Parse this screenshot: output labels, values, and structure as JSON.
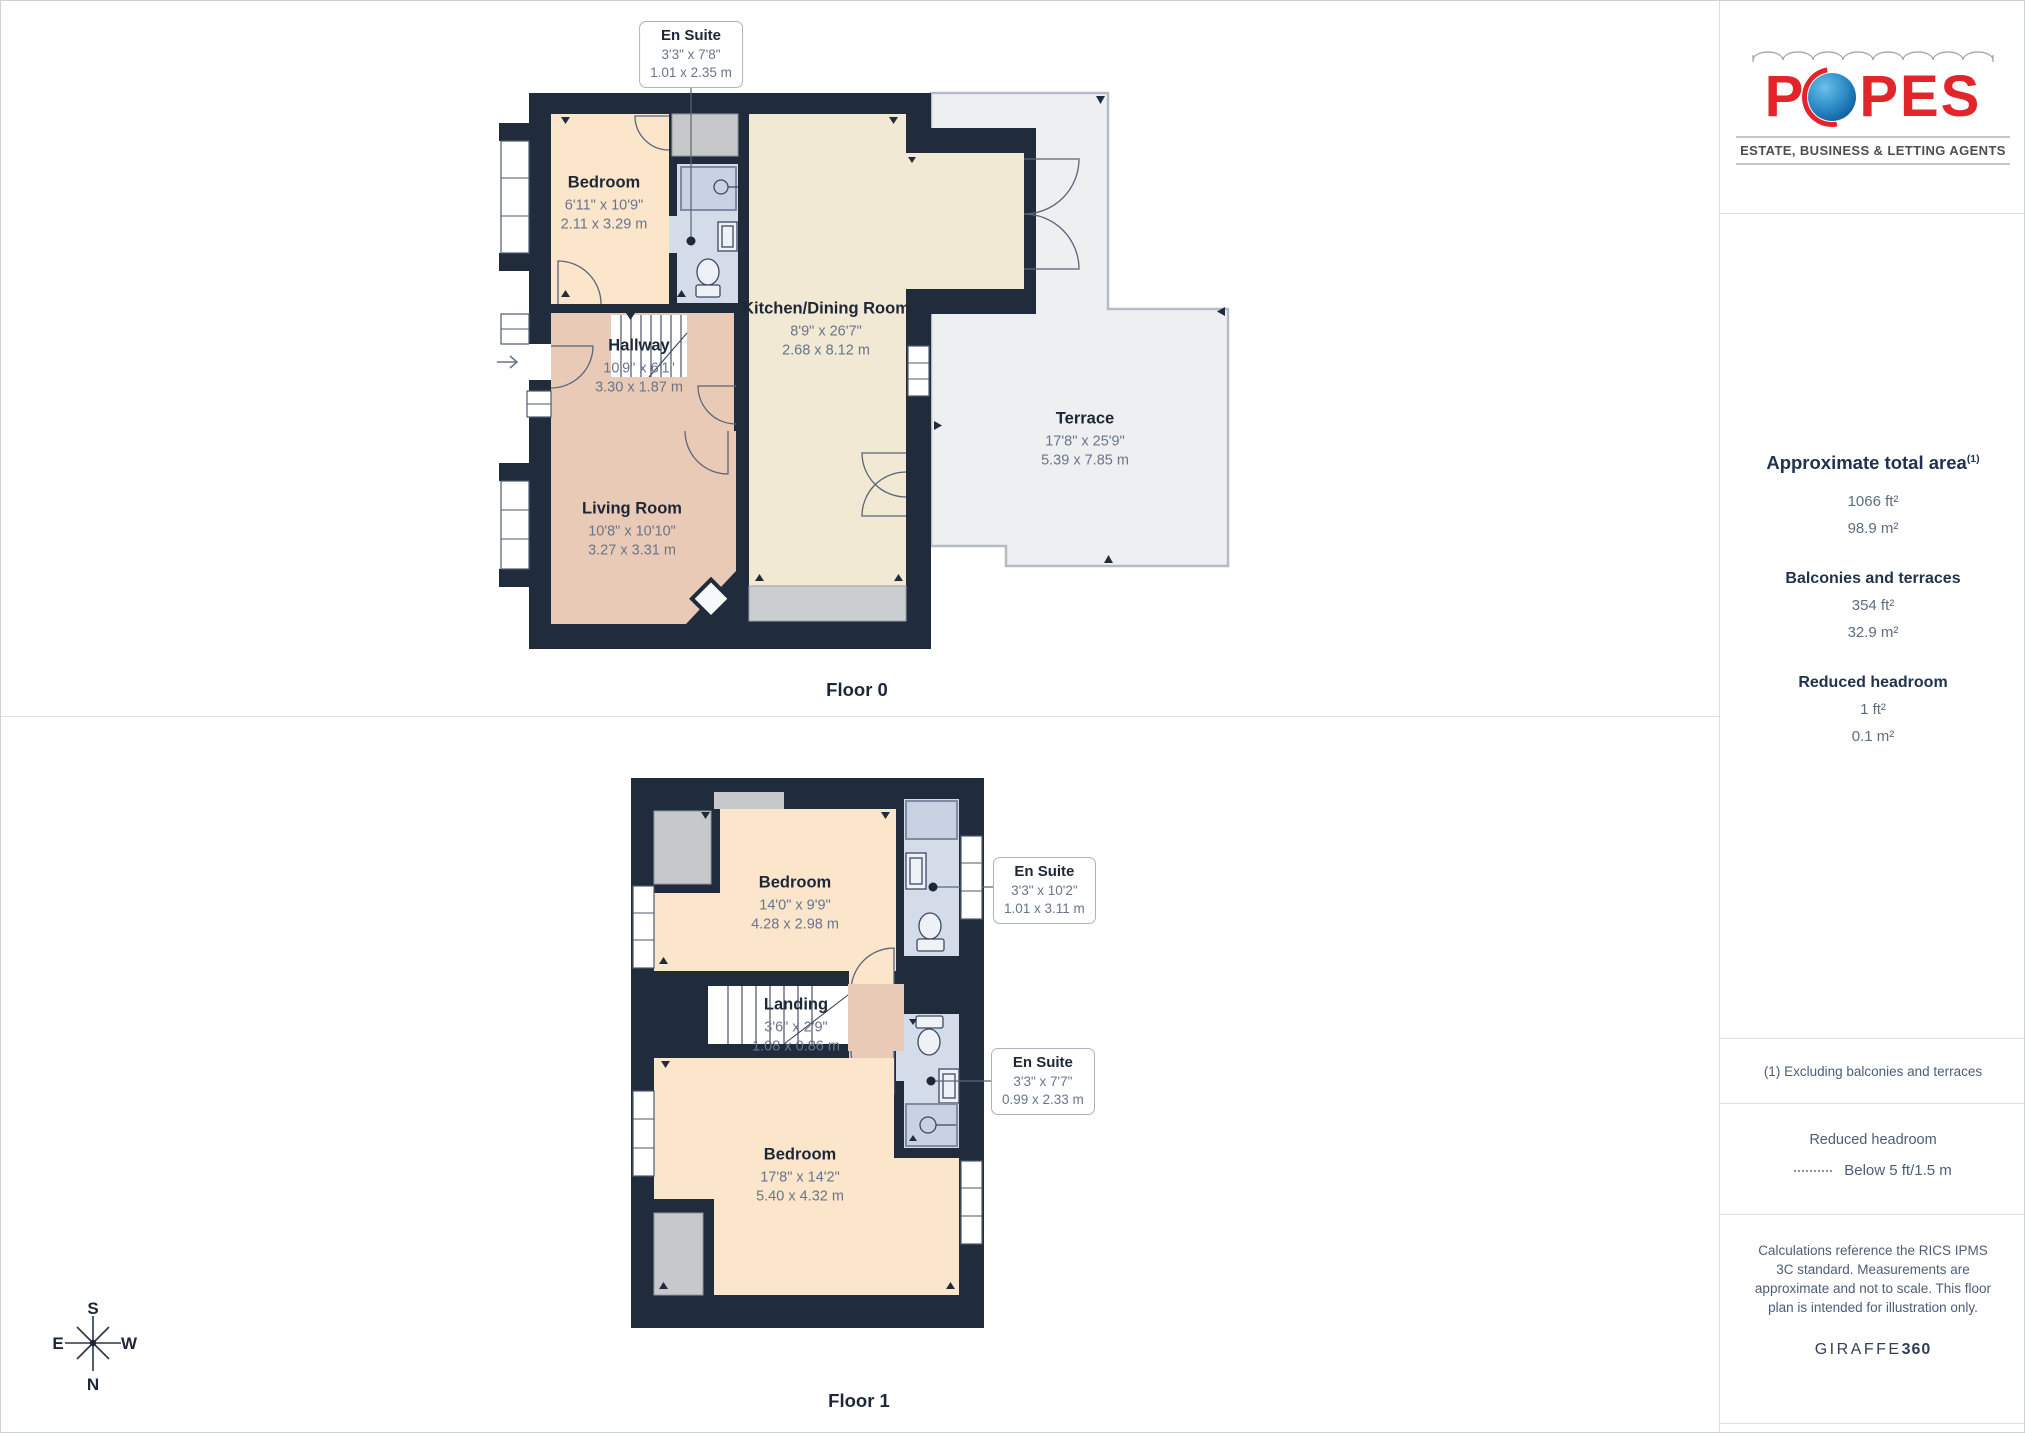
{
  "floor0": {
    "title": "Floor 0",
    "rooms": [
      {
        "name": "Bedroom",
        "imperial": "6'11\" x 10'9\"",
        "metric": "2.11 x 3.29 m"
      },
      {
        "name": "Kitchen/Dining Room",
        "imperial": "8'9\" x 26'7\"",
        "metric": "2.68 x 8.12 m"
      },
      {
        "name": "Hallway",
        "imperial": "10'9\" x 6'1\"",
        "metric": "3.30 x 1.87 m"
      },
      {
        "name": "Living Room",
        "imperial": "10'8\" x 10'10\"",
        "metric": "3.27 x 3.31 m"
      },
      {
        "name": "Terrace",
        "imperial": "17'8\" x 25'9\"",
        "metric": "5.39 x 7.85 m"
      }
    ],
    "callouts": [
      {
        "name": "En Suite",
        "imperial": "3'3\" x 7'8\"",
        "metric": "1.01 x 2.35 m"
      }
    ]
  },
  "floor1": {
    "title": "Floor 1",
    "rooms": [
      {
        "name": "Bedroom",
        "imperial": "14'0\" x 9'9\"",
        "metric": "4.28 x 2.98 m"
      },
      {
        "name": "Landing",
        "imperial": "3'6\" x 2'9\"",
        "metric": "1.08 x 0.86 m"
      },
      {
        "name": "Bedroom",
        "imperial": "17'8\" x 14'2\"",
        "metric": "5.40 x 4.32 m"
      }
    ],
    "callouts": [
      {
        "name": "En Suite",
        "imperial": "3'3\" x 10'2\"",
        "metric": "1.01 x 3.11 m"
      },
      {
        "name": "En Suite",
        "imperial": "3'3\" x 7'7\"",
        "metric": "0.99 x 2.33 m"
      }
    ]
  },
  "compass": {
    "n": "N",
    "s": "S",
    "e": "E",
    "w": "W"
  },
  "sidebar": {
    "logo": {
      "left": "P",
      "right": "PES",
      "tagline": "ESTATE, BUSINESS & LETTING AGENTS"
    },
    "areas": {
      "title": "Approximate total area",
      "title_sup": "(1)",
      "total_ft": "1066 ft²",
      "total_m": "98.9 m²",
      "balconies_heading": "Balconies and terraces",
      "balconies_ft": "354 ft²",
      "balconies_m": "32.9 m²",
      "reduced_heading": "Reduced headroom",
      "reduced_ft": "1 ft²",
      "reduced_m": "0.1 m²"
    },
    "footnote": "(1) Excluding balconies and terraces",
    "legend": {
      "title": "Reduced headroom",
      "value": "Below 5 ft/1.5 m"
    },
    "disclaimer": "Calculations reference the RICS IPMS 3C standard. Measurements are approximate and not to scale. This floor plan is intended for illustration only.",
    "brand2": {
      "name": "GIRAFFE",
      "bold": "360"
    }
  },
  "colors": {
    "wall": "#202c3c",
    "accent_red": "#e2252b",
    "accent_blue": "#2f8dc7"
  }
}
